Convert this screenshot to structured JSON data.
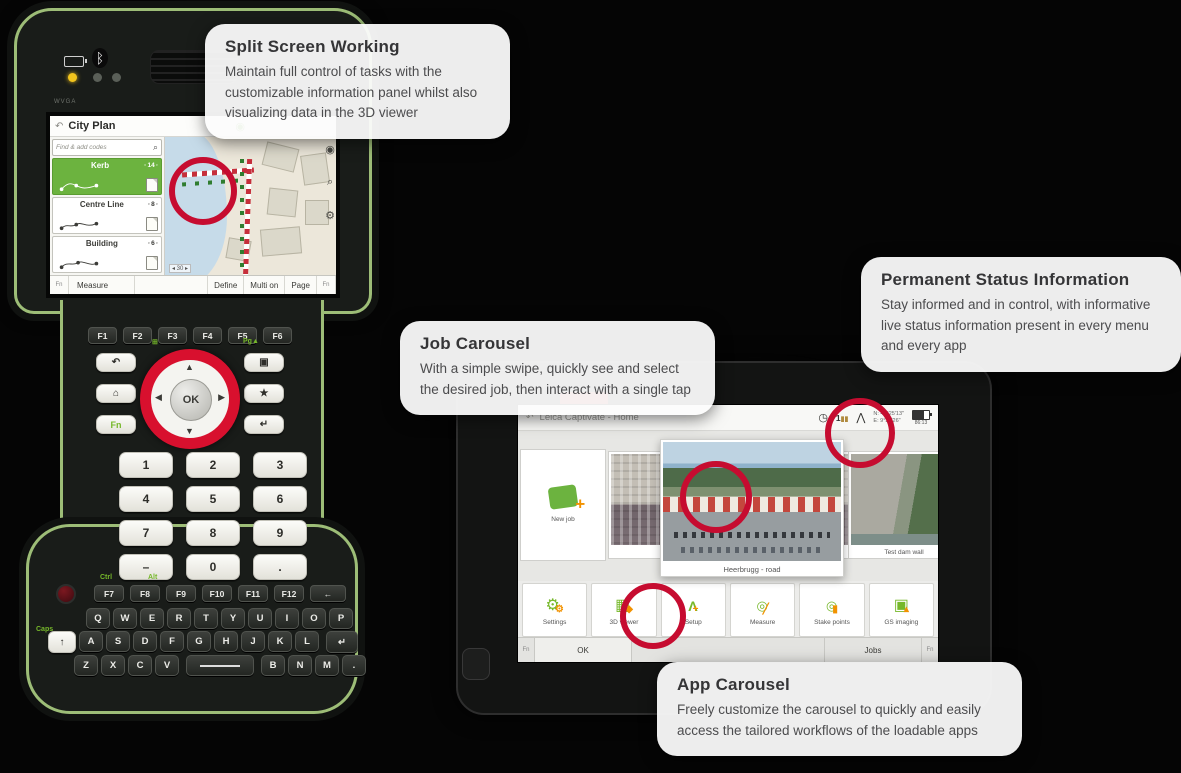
{
  "callouts": {
    "split_screen": {
      "title": "Split Screen Working",
      "body": "Maintain full control of tasks with the customizable information panel whilst also visualizing data in the 3D viewer"
    },
    "job_carousel": {
      "title": "Job Carousel",
      "body": "With a simple swipe, quickly see and select the desired job, then interact with a single tap"
    },
    "status_info": {
      "title": "Permanent Status Information",
      "body": "Stay informed and in control, with informative live status information present in every menu and every app"
    },
    "app_carousel": {
      "title": "App Carousel",
      "body": "Freely customize the carousel to quickly and easily access the tailored workflows of the loadable apps"
    }
  },
  "controller": {
    "bezel_label": "WVGA",
    "screen": {
      "title": "City Plan",
      "back_icon": "↶",
      "gs_icon": "◉",
      "search_placeholder": "Find & add codes",
      "search_icon": "⌕",
      "layers": [
        {
          "name": "Kerb",
          "count": "14"
        },
        {
          "name": "Centre Line",
          "count": "8"
        },
        {
          "name": "Building",
          "count": "6"
        }
      ],
      "map_tools": {
        "layers": "◉",
        "zoom": "⌕",
        "settings": "⚙"
      },
      "map_scale": "◂ 30 ▸",
      "toolbar": [
        "Fn",
        "Measure",
        "Define",
        "Multi on",
        "Page",
        "Fn"
      ]
    },
    "fkeys_top": [
      "F1",
      "F2",
      "F3",
      "F4",
      "F5",
      "F6"
    ],
    "nav": {
      "back": "↶",
      "home": "⌂",
      "fn": "Fn",
      "screen": "▣",
      "star": "★",
      "enter": "↵",
      "ok": "OK",
      "pg_up": "Pg▲",
      "pg_dn": "Pg▼",
      "win": "⊞"
    },
    "numpad": [
      "1",
      "2",
      "3",
      "4",
      "5",
      "6",
      "7",
      "8",
      "9",
      "–",
      "0",
      "."
    ],
    "modifier_labels": {
      "ctrl": "Ctrl",
      "alt": "Alt",
      "caps": "Caps"
    },
    "fkeys_bottom": [
      "F7",
      "F8",
      "F9",
      "F10",
      "F11",
      "F12"
    ],
    "backspace": "←",
    "shift": "↑",
    "enter": "↵",
    "qwerty": [
      [
        "Q",
        "W",
        "E",
        "R",
        "T",
        "Y",
        "U",
        "I",
        "O",
        "P"
      ],
      [
        "A",
        "S",
        "D",
        "F",
        "G",
        "H",
        "J",
        "K",
        "L"
      ],
      [
        "Z",
        "X",
        "C",
        "V",
        "B",
        "N",
        "M",
        "."
      ]
    ]
  },
  "tablet": {
    "titlebar": {
      "back_icon": "↶",
      "title": "Leica Captivate - Home",
      "clock_icon": "◷",
      "gs_value": "1",
      "instrument_icon": "⋀",
      "coords_line1": "N: 47°25'13\"",
      "coords_line2": "E: 9°37'26\"",
      "battery_label": "86:13",
      "search_icon": "⌕"
    },
    "jobs": [
      {
        "label": "New job"
      },
      {
        "label": "East Facade"
      },
      {
        "label": "Heerbrugg - road"
      },
      {
        "label": "Test dam wall"
      }
    ],
    "apps": [
      "Settings",
      "3D viewer",
      "Setup",
      "Measure",
      "Stake points",
      "GS imaging"
    ],
    "bottombar": {
      "fn_left": "Fn",
      "ok": "OK",
      "jobs": "Jobs",
      "fn_right": "Fn"
    }
  }
}
